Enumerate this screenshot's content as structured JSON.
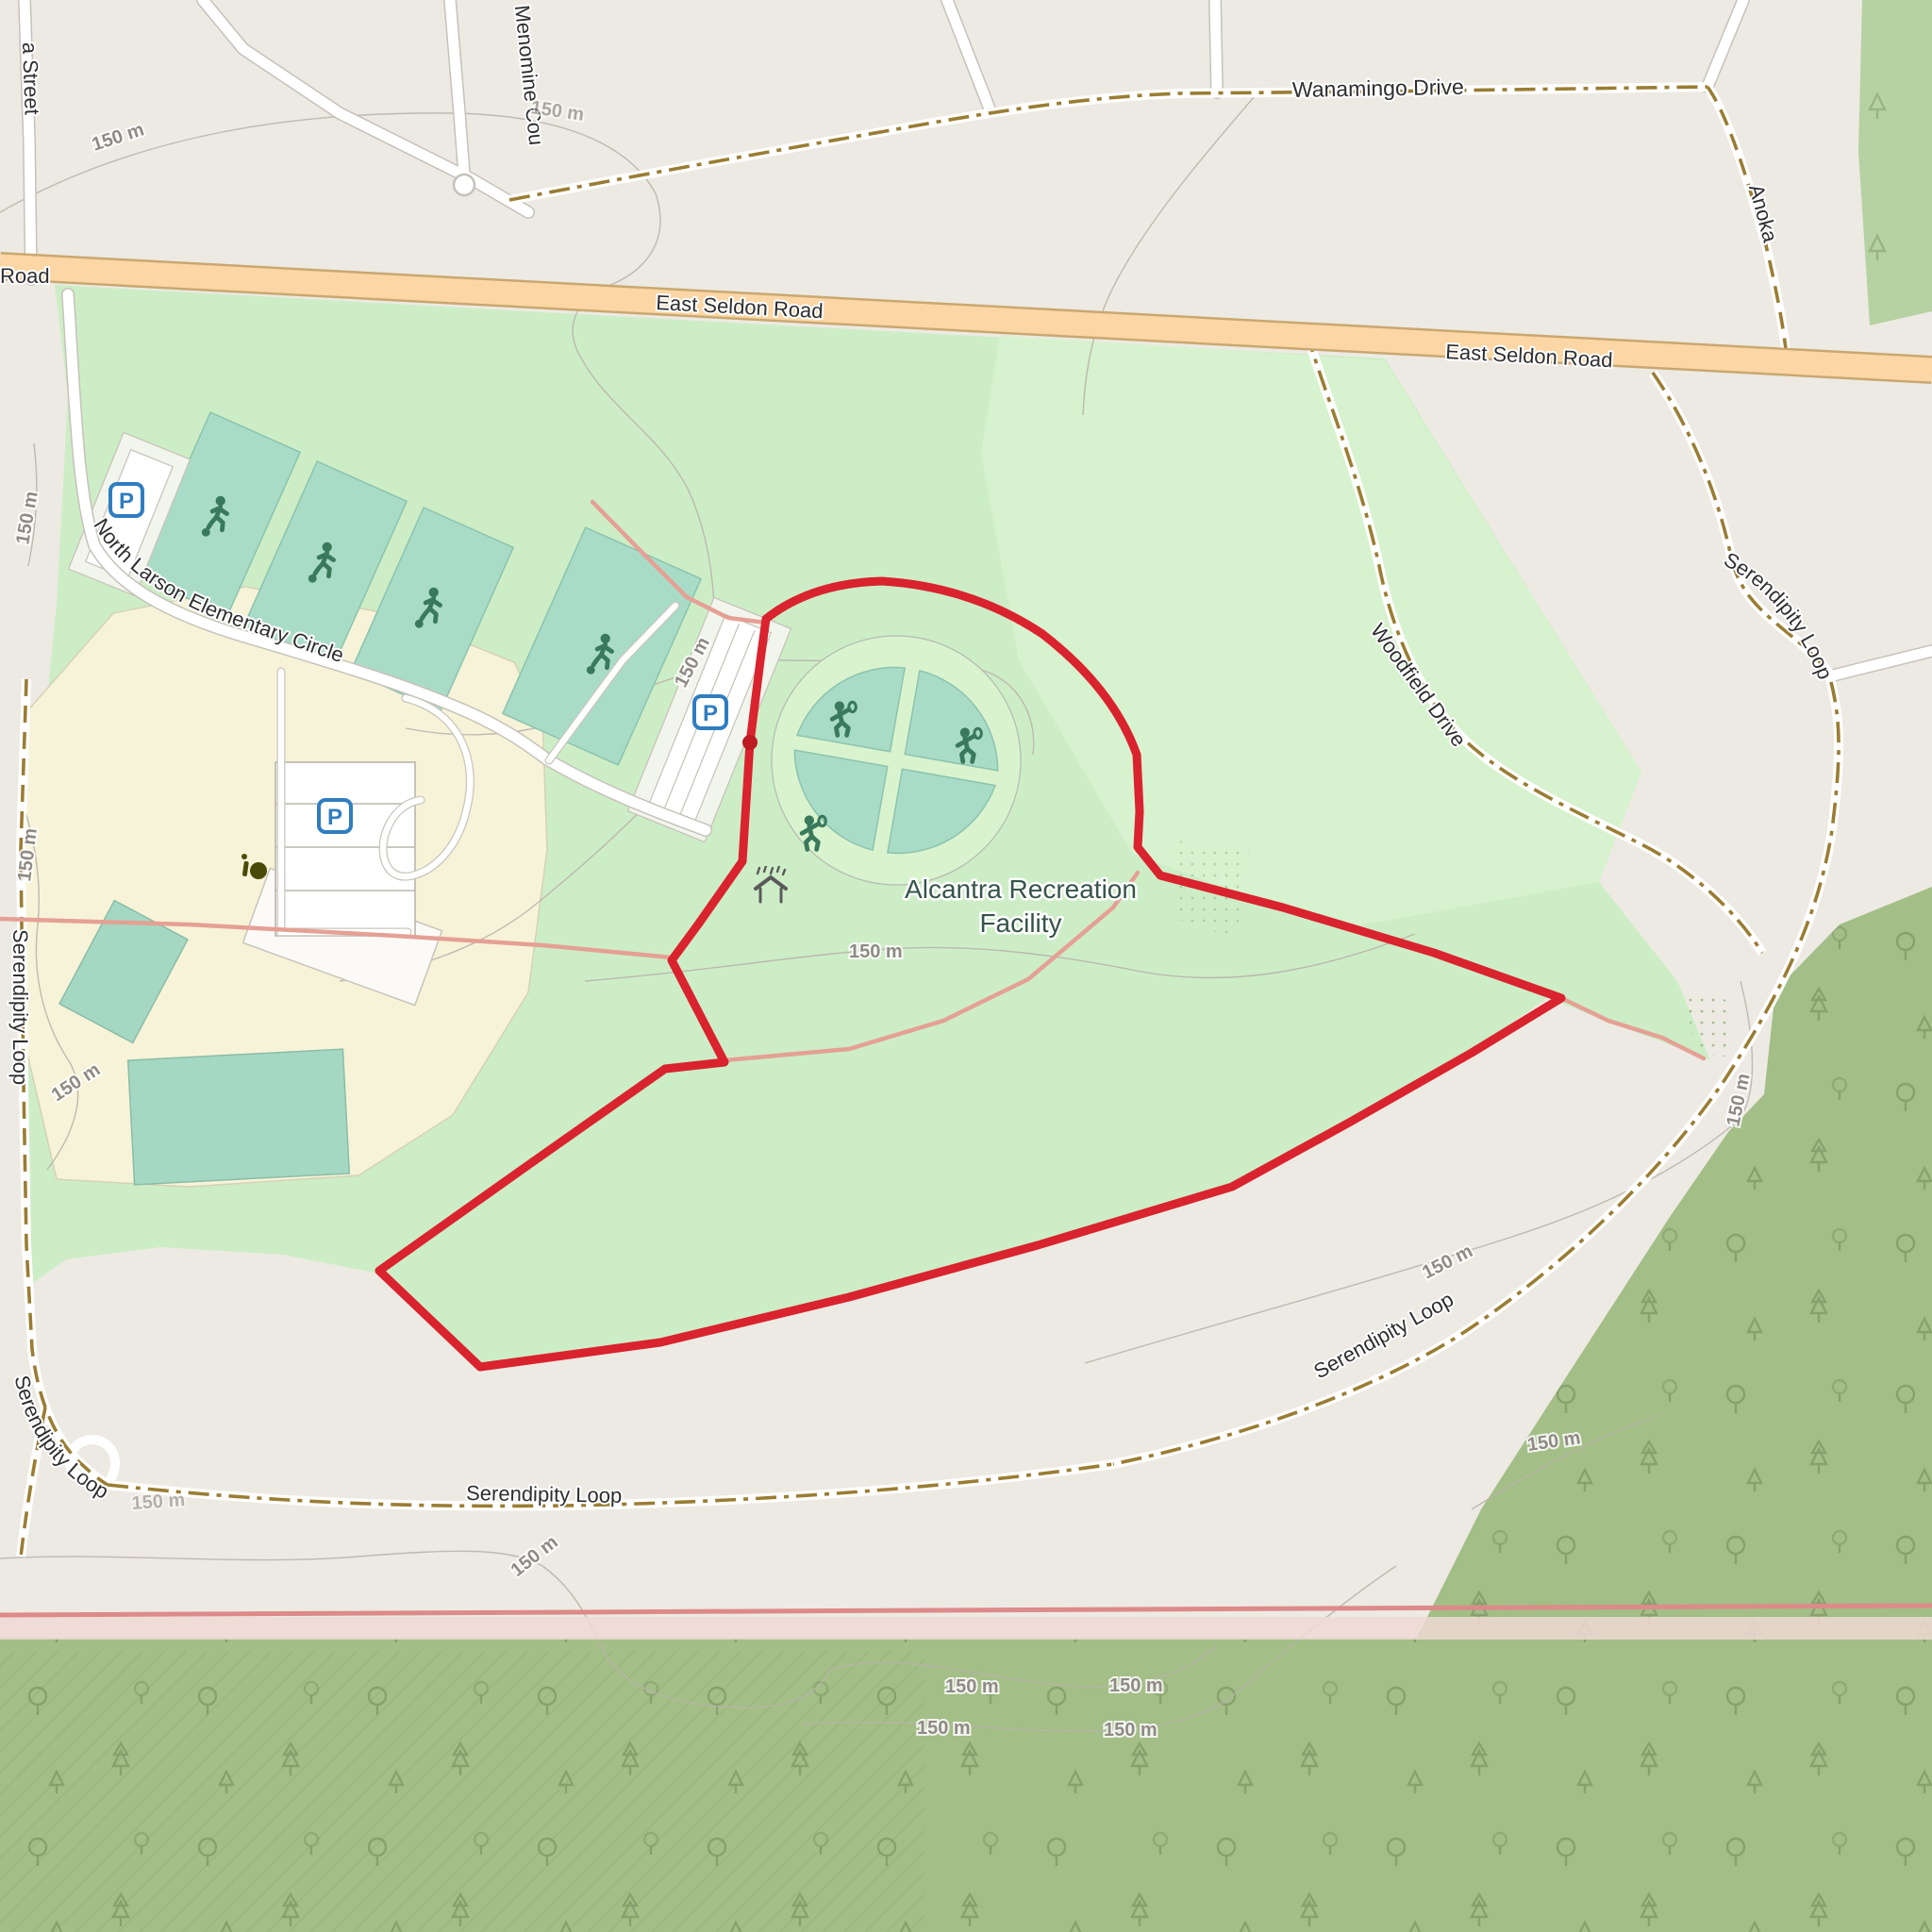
{
  "map_type": "openstreetmap-style recreation area map with gps route overlay",
  "labels": {
    "street_partial": "a Street",
    "road_partial": "Road",
    "menomine_court": "Menomine Cou",
    "wanamingo_drive": "Wanamingo Drive",
    "anoka": "Anoka",
    "east_seldon_road": "East Seldon Road",
    "north_larson": "North Larson Elementary Circle",
    "serendipity_loop": "Serendipity Loop",
    "woodfield_drive": "Woodfield Drive",
    "facility_name_line1": "Alcantra Recreation",
    "facility_name_line2": "Facility",
    "contour_150m": "150 m",
    "parking_letter": "P"
  },
  "icons": {
    "parking": "parking-icon (blue rounded square with P)",
    "soccer": "soccer-player-icon",
    "tennis": "tennis-player-icon",
    "shelter": "rain-shelter-icon",
    "orchard": "fruit-tree-icon",
    "trees": [
      "deciduous-tree-icon",
      "conifer-tree-icon"
    ],
    "route_start": "route-start-dot"
  },
  "colors": {
    "route_red": "#d9232e",
    "route_dot": "#bd1a23",
    "path_salmon": "#e5a095",
    "primary_road_fill": "#fcd6a4",
    "primary_road_casing": "#c9a870",
    "track_dash": "#9a7d33",
    "residential_road": "#ffffff",
    "park_green": "#cdedc6",
    "park_green_light": "#d9f3cf",
    "pitch_teal": "#a9dcc7",
    "school_yellow": "#f6f3d8",
    "forest_green": "#a3be86",
    "forest_green_light": "#b6d1a2",
    "urban_grey": "#edeae3",
    "contour_grey": "#b9b4ab",
    "boundary_pink": "#dd8a8a",
    "parking_blue": "#2f7dc1",
    "icon_green": "#3a7a5c",
    "label_black": "#2e2e2e",
    "poi_label_green": "#36544a"
  }
}
